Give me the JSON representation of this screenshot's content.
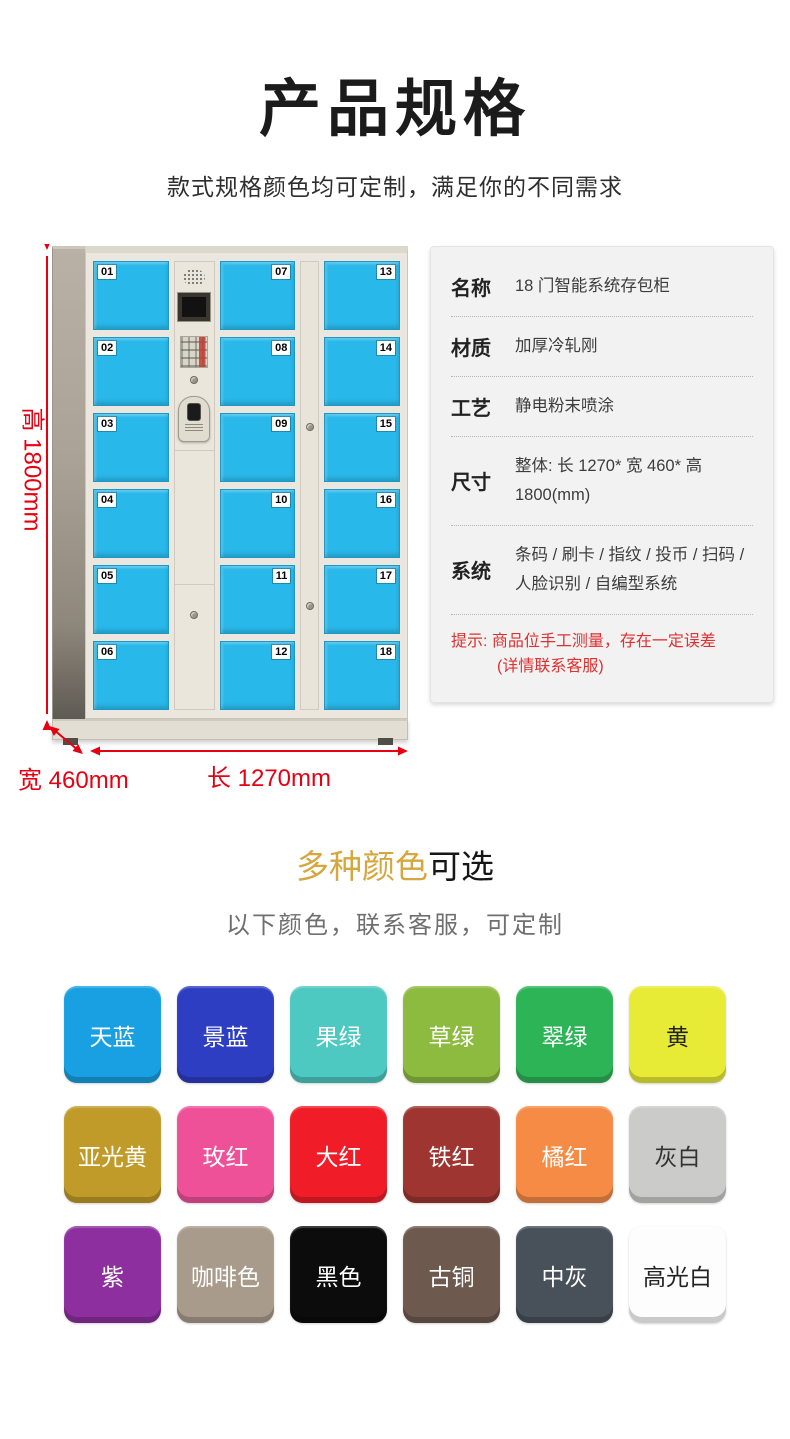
{
  "page": {
    "title": "产品规格",
    "subtitle": "款式规格颜色均可定制，满足你的不同需求"
  },
  "locker": {
    "door_numbers": [
      "01",
      "02",
      "03",
      "04",
      "05",
      "06",
      "07",
      "08",
      "09",
      "10",
      "11",
      "12",
      "13",
      "14",
      "15",
      "16",
      "17",
      "18"
    ],
    "door_color": "#29b8ea",
    "dimension_color": "#e60012",
    "dim_height": "高 1800mm",
    "dim_width": "宽 460mm",
    "dim_length": "长 1270mm"
  },
  "specs": {
    "rows": [
      {
        "label": "名称",
        "value": "18 门智能系统存包柜"
      },
      {
        "label": "材质",
        "value": "加厚冷轧刚"
      },
      {
        "label": "工艺",
        "value": "静电粉末喷涂"
      },
      {
        "label": "尺寸",
        "value": "整体: 长 1270* 宽 460* 高 1800(mm)"
      },
      {
        "label": "系统",
        "value": "条码 / 刷卡 / 指纹 / 投币 / 扫码 / 人脸识别 / 自编型系统"
      }
    ],
    "note_line1": "提示: 商品位手工测量，存在一定误差",
    "note_line2": "(详情联系客服)",
    "note_color": "#e03030"
  },
  "colors_section": {
    "heading_highlight": "多种颜色",
    "heading_rest": "可选",
    "highlight_color": "#d5a73e",
    "subtitle": "以下颜色，联系客服，可定制",
    "swatches": [
      {
        "label": "天蓝",
        "color": "#18a0e2",
        "text": "#ffffff"
      },
      {
        "label": "景蓝",
        "color": "#2d3ec3",
        "text": "#ffffff"
      },
      {
        "label": "果绿",
        "color": "#4ec9c1",
        "text": "#ffffff"
      },
      {
        "label": "草绿",
        "color": "#8dbb40",
        "text": "#ffffff"
      },
      {
        "label": "翠绿",
        "color": "#2cb457",
        "text": "#ffffff"
      },
      {
        "label": "黄",
        "color": "#e7eb36",
        "text": "#222222"
      },
      {
        "label": "亚光黄",
        "color": "#c09b2a",
        "text": "#ffffff"
      },
      {
        "label": "玫红",
        "color": "#ef5199",
        "text": "#ffffff"
      },
      {
        "label": "大红",
        "color": "#f01d29",
        "text": "#ffffff"
      },
      {
        "label": "铁红",
        "color": "#9e3531",
        "text": "#ffffff"
      },
      {
        "label": "橘红",
        "color": "#f68b45",
        "text": "#ffffff"
      },
      {
        "label": "灰白",
        "color": "#cbcbca",
        "text": "#333333"
      },
      {
        "label": "紫",
        "color": "#8d2f9e",
        "text": "#ffffff"
      },
      {
        "label": "咖啡色",
        "color": "#a99b8b",
        "text": "#ffffff"
      },
      {
        "label": "黑色",
        "color": "#0c0c0c",
        "text": "#ffffff"
      },
      {
        "label": "古铜",
        "color": "#6e594f",
        "text": "#ffffff"
      },
      {
        "label": "中灰",
        "color": "#48505a",
        "text": "#ffffff"
      },
      {
        "label": "高光白",
        "color": "#fdfdfd",
        "text": "#222222"
      }
    ]
  }
}
